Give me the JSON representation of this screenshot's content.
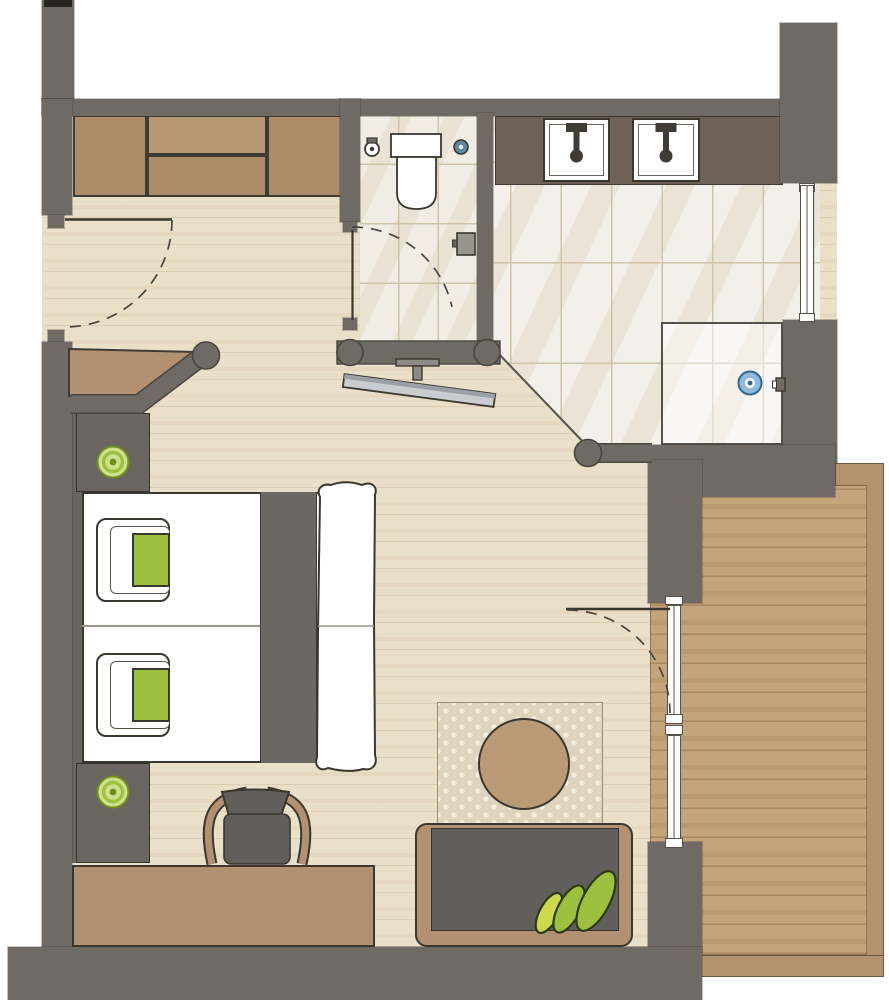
{
  "app": {
    "type": "hotel-room-floor-plan",
    "text_labels": []
  },
  "colors": {
    "wall": "#6f6a63",
    "black_cap": "#262522",
    "wood": "#eadfc9",
    "balcony_wood": "#c3a47b",
    "balcony_border": "#b2936d",
    "tile": "#f3f0ea",
    "wc_tile": "#f1ede4",
    "tile_line": "#cfc3ab",
    "wardrobe": "#ad8c6c",
    "wardrobe_light": "#b69776",
    "counter": "#6e6156",
    "ink": "#3a372f",
    "dark_furniture": "#615f5c",
    "runner": "#6b6864",
    "nightstand": "#6b6560",
    "tan": "#b29173",
    "table": "#bb9a78",
    "rug": "#ded3bc",
    "rug_dot": "#f4eede",
    "green": "#9cc13f",
    "green_light": "#cfe08d",
    "green_dark": "#6f8f1f",
    "leaf_yellow": "#ccd94d",
    "tv": "#c9ccd1",
    "tv_edge": "#9ba0a8",
    "metal": "#8e8a85",
    "drain_blue": "#8fb9dc",
    "drain_blue_dark": "#33688f",
    "fixture_blue": "#5d86a3",
    "frame_line": "#55524c",
    "arc": "#4a4540"
  },
  "plan": {
    "rooms": [
      "entry-hall",
      "wc",
      "bathroom",
      "shower",
      "bedroom-living",
      "balcony"
    ],
    "furniture": [
      "wardrobe",
      "entry-bench",
      "toilet",
      "double-washbasin-counter",
      "shower-tray",
      "tv",
      "twin-beds",
      "pillows",
      "bed-runner",
      "nightstands",
      "reading-lamps",
      "desk",
      "desk-chair",
      "rug",
      "round-table",
      "sofa-bench",
      "plant-leaves"
    ],
    "openings": [
      "entry-door",
      "wc-door",
      "balcony-door",
      "bathroom-window",
      "balcony-window"
    ]
  }
}
